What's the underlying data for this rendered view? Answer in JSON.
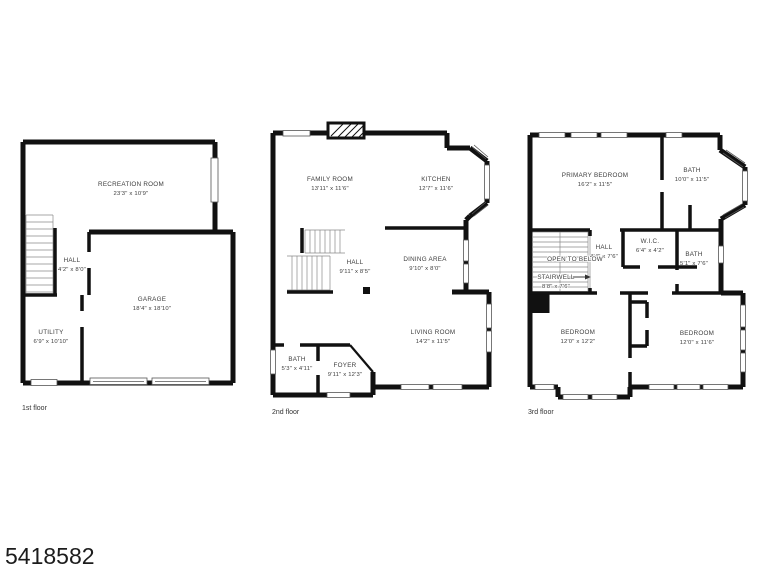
{
  "watermark": {
    "id": "5418582"
  },
  "colors": {
    "wall": "#111111",
    "text": "#3d3d3d",
    "background": "#ffffff"
  },
  "floors": [
    {
      "label": "1st floor",
      "rooms": [
        {
          "name": "RECREATION ROOM",
          "dims": "23'3\" x 10'9\""
        },
        {
          "name": "HALL",
          "dims": "4'2\" x 8'0\""
        },
        {
          "name": "GARAGE",
          "dims": "18'4\" x 18'10\""
        },
        {
          "name": "UTILITY",
          "dims": "6'9\" x 10'10\""
        }
      ]
    },
    {
      "label": "2nd floor",
      "rooms": [
        {
          "name": "FAMILY ROOM",
          "dims": "13'11\" x 11'6\""
        },
        {
          "name": "KITCHEN",
          "dims": "12'7\" x 11'6\""
        },
        {
          "name": "HALL",
          "dims": "9'11\" x 8'5\""
        },
        {
          "name": "DINING AREA",
          "dims": "9'10\" x 8'0\""
        },
        {
          "name": "LIVING ROOM",
          "dims": "14'2\" x 11'5\""
        },
        {
          "name": "BATH",
          "dims": "5'3\" x 4'11\""
        },
        {
          "name": "FOYER",
          "dims": "9'11\" x 12'3\""
        }
      ]
    },
    {
      "label": "3rd floor",
      "rooms": [
        {
          "name": "PRIMARY BEDROOM",
          "dims": "16'2\" x 11'5\""
        },
        {
          "name": "BATH",
          "dims": "10'0\" x 11'5\""
        },
        {
          "name": "W.I.C.",
          "dims": "6'4\" x 4'2\""
        },
        {
          "name": "HALL",
          "dims": "4'4\" x 7'6\""
        },
        {
          "name": "BATH",
          "dims": "5'1\" x 7'6\""
        },
        {
          "name": "STAIRWELL",
          "dims": "8'8\" x 7'6\""
        },
        {
          "name": "BEDROOM",
          "dims": "12'0\" x 12'2\""
        },
        {
          "name": "BEDROOM",
          "dims": "12'0\" x 11'6\""
        }
      ],
      "annotations": {
        "open_to_below": "OPEN TO BELOW"
      }
    }
  ]
}
